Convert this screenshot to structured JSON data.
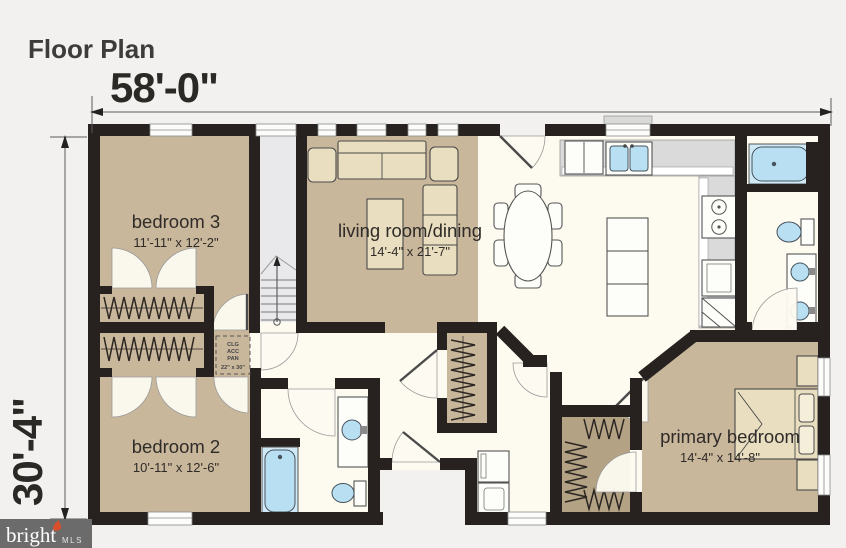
{
  "page": {
    "title": "Floor Plan"
  },
  "dimensions": {
    "overall_width": "58'-0\"",
    "overall_depth": "30'-4\""
  },
  "rooms": {
    "bedroom3": {
      "name": "bedroom 3",
      "size": "11'-11\" x 12'-2\""
    },
    "living_dining": {
      "name": "living room/dining",
      "size": "14'-4\" x 21'-7\""
    },
    "bedroom2": {
      "name": "bedroom 2",
      "size": "10'-11\" x 12'-6\""
    },
    "primary_bedroom": {
      "name": "primary bedroom",
      "size": "14'-4\" x 14'-8\""
    }
  },
  "labels": {
    "ceiling_access_line1": "CLG",
    "ceiling_access_line2": "ACC",
    "ceiling_access_line3": "PAN",
    "ceiling_access_line4": "22\" x 30\""
  },
  "watermark": {
    "brand": "bright",
    "suffix": "MLS"
  },
  "colors": {
    "background": "#f2f1ef",
    "wall": "#272220",
    "room_tan": "#c9b79c",
    "floor_cream": "#fdfbf0",
    "fixture_blue": "#b9e0f2",
    "counter_gray": "#dadada",
    "stairs_gray": "#e9e9ec",
    "watermark_gray": "#6b6b6b",
    "watermark_accent": "#d94f2b"
  }
}
